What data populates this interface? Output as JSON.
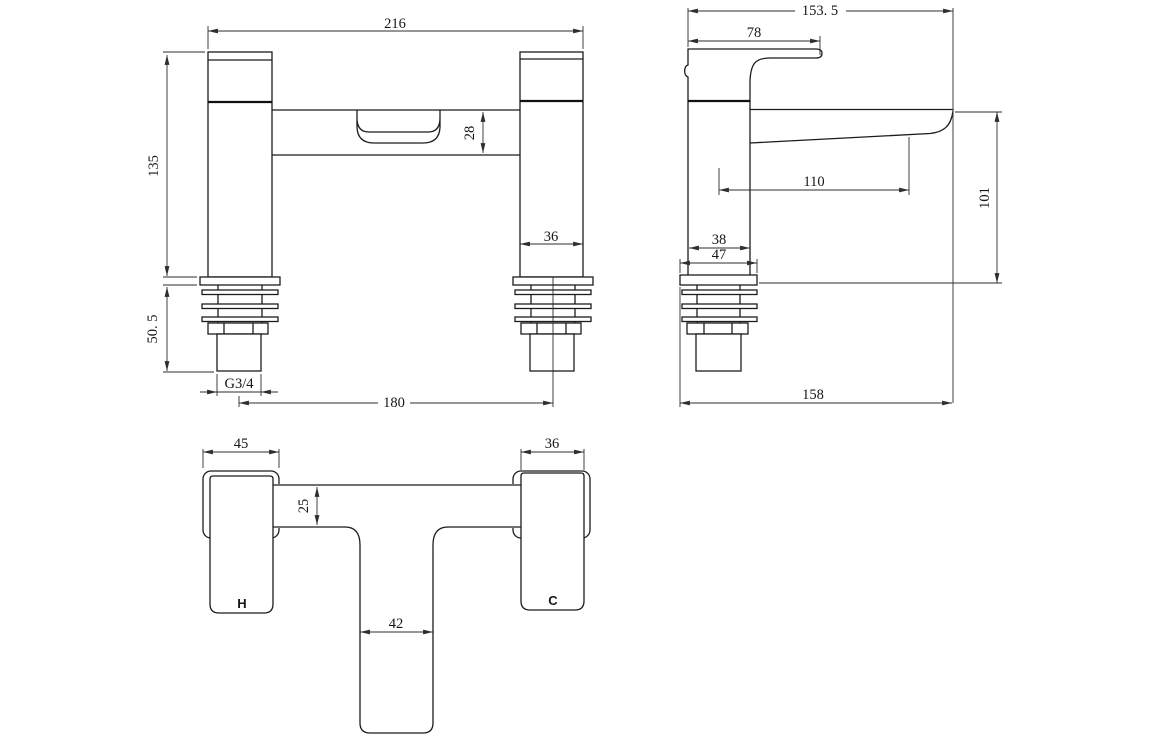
{
  "colors": {
    "background": "#ffffff",
    "line": "#1c1c1c",
    "dimension": "#2e2e2e"
  },
  "front_view": {
    "dims": {
      "overall_width": "216",
      "body_height": "135",
      "spout_body_height": "28",
      "pillar_width": "36",
      "shank_length": "50. 5",
      "thread_size": "G3/4",
      "tap_centres": "180"
    }
  },
  "side_view": {
    "dims": {
      "overall_depth": "153. 5",
      "handle_reach": "78",
      "spout_reach": "110",
      "spout_height_above_deck": "101",
      "body_depth": "38",
      "flange_depth": "47",
      "overall_reach": "158"
    }
  },
  "bottom_view": {
    "dims": {
      "hot_end_width": "45",
      "handle_width": "36",
      "deck_bar_depth": "25",
      "spout_width": "42"
    },
    "labels": {
      "hot": "H",
      "cold": "C"
    }
  }
}
